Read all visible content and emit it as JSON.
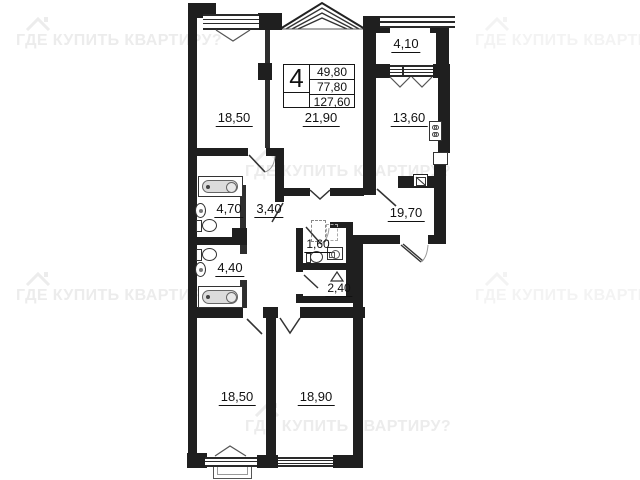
{
  "watermark": {
    "text": "ГДЕ КУПИТЬ КВАРТИРУ?"
  },
  "spec_box": {
    "rooms_count": "4",
    "living_area": "49,80",
    "apartment_area": "77,80",
    "total_area": "127,60"
  },
  "rooms": [
    {
      "name": "bedroom-top",
      "area": "18,50"
    },
    {
      "name": "living-room",
      "area": "21,90"
    },
    {
      "name": "kitchen",
      "area": "13,60"
    },
    {
      "name": "balcony",
      "area": "4,10"
    },
    {
      "name": "bathroom-1",
      "area": "4,70"
    },
    {
      "name": "corridor",
      "area": "3,40"
    },
    {
      "name": "hallway",
      "area": "19,70"
    },
    {
      "name": "bathroom-2",
      "area": "4,40"
    },
    {
      "name": "wc",
      "area": "1,60"
    },
    {
      "name": "storeroom",
      "area": "2,40"
    },
    {
      "name": "bedroom-bottom-left",
      "area": "18,50"
    },
    {
      "name": "bedroom-bottom-right",
      "area": "18,90"
    }
  ],
  "colors": {
    "wall": "#1f1f1f",
    "watermark": "#ececec",
    "fixture_fill": "#dcdcdc"
  }
}
